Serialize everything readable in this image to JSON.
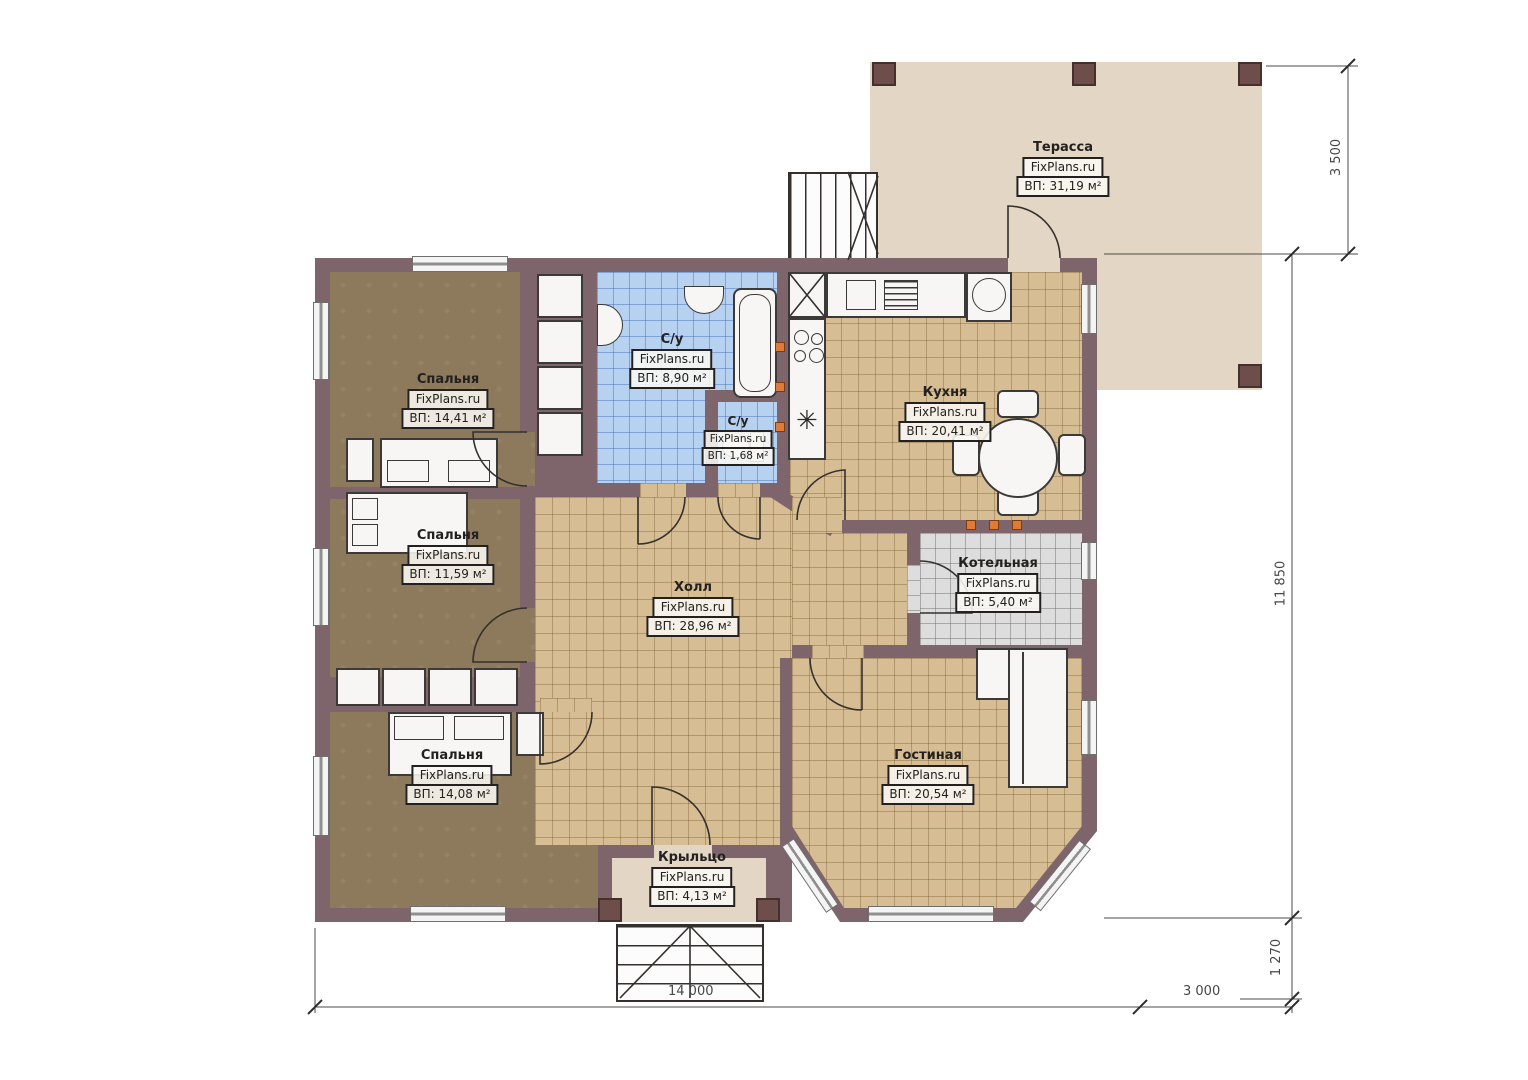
{
  "plan": {
    "brand": "FixPlans.ru",
    "rooms": {
      "terrace": {
        "name": "Терасса",
        "area": "ВП: 31,19 м²"
      },
      "bedroom1": {
        "name": "Спальня",
        "area": "ВП: 14,41 м²"
      },
      "bedroom2": {
        "name": "Спальня",
        "area": "ВП: 11,59 м²"
      },
      "bedroom3": {
        "name": "Спальня",
        "area": "ВП: 14,08 м²"
      },
      "bathroom": {
        "name": "С/у",
        "area": "ВП: 8,90 м²"
      },
      "wc": {
        "name": "С/у",
        "area": "ВП: 1,68 м²"
      },
      "kitchen": {
        "name": "Кухня",
        "area": "ВП: 20,41 м²"
      },
      "boiler": {
        "name": "Котельная",
        "area": "ВП: 5,40 м²"
      },
      "hall": {
        "name": "Холл",
        "area": "ВП: 28,96 м²"
      },
      "living": {
        "name": "Гостиная",
        "area": "ВП: 20,54 м²"
      },
      "porch": {
        "name": "Крыльцо",
        "area": "ВП: 4,13 м²"
      }
    },
    "dimensions": {
      "terrace_depth": "3 500",
      "house_depth": "11 850",
      "porch_depth": "1 270",
      "house_width": "14 000",
      "terrace_width": "3 000"
    },
    "icons": {
      "fridge": "✳"
    },
    "colors": {
      "wall": "#7e656b",
      "terrace_floor": "#e4d6c4",
      "tile_tan": "#d7bd93",
      "tile_blue": "#b7d2f1",
      "tile_gray": "#dddddd",
      "bedroom_floor": "#8d7a5c",
      "accent_orange": "#e07b35"
    }
  }
}
